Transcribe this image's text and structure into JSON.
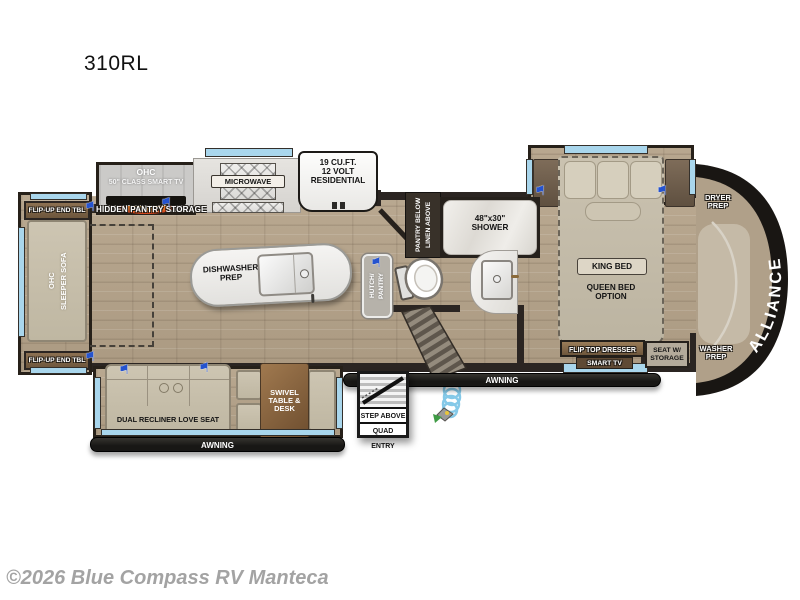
{
  "page": {
    "title": "310RL",
    "watermark": "©2026 Blue Compass RV Manteca"
  },
  "colors": {
    "floor": "#b3a28c",
    "wall": "#2b2522",
    "window_glass": "#a9d6ec",
    "slide_flag": "#2553cf",
    "front_cap": "#191613",
    "awning_bar": "#1d1c1a"
  },
  "icons": {
    "flag": "⚑"
  },
  "floorplan": {
    "entertainment": {
      "ohc": "OHC",
      "tv": "50\" CLASS SMART TV",
      "hidden_pantry": "HIDDEN PANTRY STORAGE"
    },
    "kitchen": {
      "microwave": "MICROWAVE",
      "fridge_l1": "19 CU.FT.",
      "fridge_l2": "12 VOLT",
      "fridge_l3": "RESIDENTIAL",
      "island_l1": "DISHWASHER",
      "island_l2": "PREP"
    },
    "left_slide": {
      "end_table_top": "FLIP-UP END TBL",
      "end_table_bottom": "FLIP-UP END TBL",
      "ohc": "OHC",
      "sofa": "SLEEPER SOFA"
    },
    "bath": {
      "pantry_col1": "PANTRY BELOW",
      "pantry_col2": "LINEN ABOVE",
      "shower_l1": "48\"x30\"",
      "shower_l2": "SHOWER",
      "hutch_col1": "HUTCH/",
      "hutch_col2": "PANTRY"
    },
    "bedroom": {
      "king": "KING BED",
      "queen_l1": "QUEEN BED",
      "queen_l2": "OPTION",
      "dresser": "FLIP TOP DRESSER",
      "smart_tv": "SMART TV",
      "seat_l1": "SEAT W/",
      "seat_l2": "STORAGE"
    },
    "front": {
      "brand": "ALLIANCE",
      "dryer_l1": "DRYER",
      "dryer_l2": "PREP",
      "washer_l1": "WASHER",
      "washer_l2": "PREP"
    },
    "living": {
      "love_seat": "DUAL RECLINER LOVE SEAT",
      "table_l1": "SWIVEL",
      "table_l2": "TABLE &",
      "table_l3": "DESK"
    },
    "entry": {
      "l1": "STEP ABOVE",
      "l2": "QUAD ENTRY"
    },
    "awning_left": "AWNING",
    "awning_right": "AWNING"
  }
}
